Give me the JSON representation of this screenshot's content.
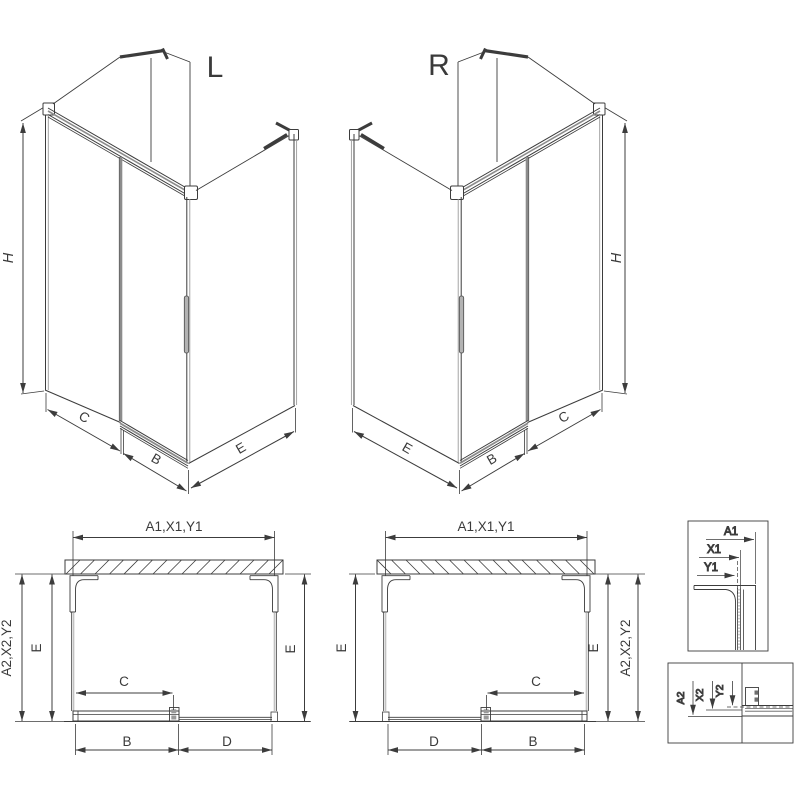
{
  "drawing": {
    "iso_left": {
      "label": "L",
      "dim_h": "H",
      "dim_c": "C",
      "dim_b": "B",
      "dim_e": "E"
    },
    "iso_right": {
      "label": "R",
      "dim_h": "H",
      "dim_c": "C",
      "dim_b": "B",
      "dim_e": "E"
    },
    "plan_left": {
      "dim_top": "A1,X1,Y1",
      "dim_left_outer": "A2,X2,Y2",
      "dim_left_inner": "E",
      "dim_right": "E",
      "dim_c": "C",
      "dim_b": "B",
      "dim_d": "D"
    },
    "plan_right": {
      "dim_top": "A1,X1,Y1",
      "dim_left": "E",
      "dim_right_inner": "E",
      "dim_right_outer": "A2,X2,Y2",
      "dim_c": "C",
      "dim_d": "D",
      "dim_b": "B"
    },
    "detail_wall_profile": {
      "dim_a1": "A1",
      "dim_x1": "X1",
      "dim_y1": "Y1"
    },
    "detail_floor_rail": {
      "dim_a2": "A2",
      "dim_x2": "X2",
      "dim_y2": "Y2"
    },
    "colors": {
      "line": "#3c3c3c",
      "grey": "#8c8c8c",
      "background": "#ffffff"
    }
  }
}
